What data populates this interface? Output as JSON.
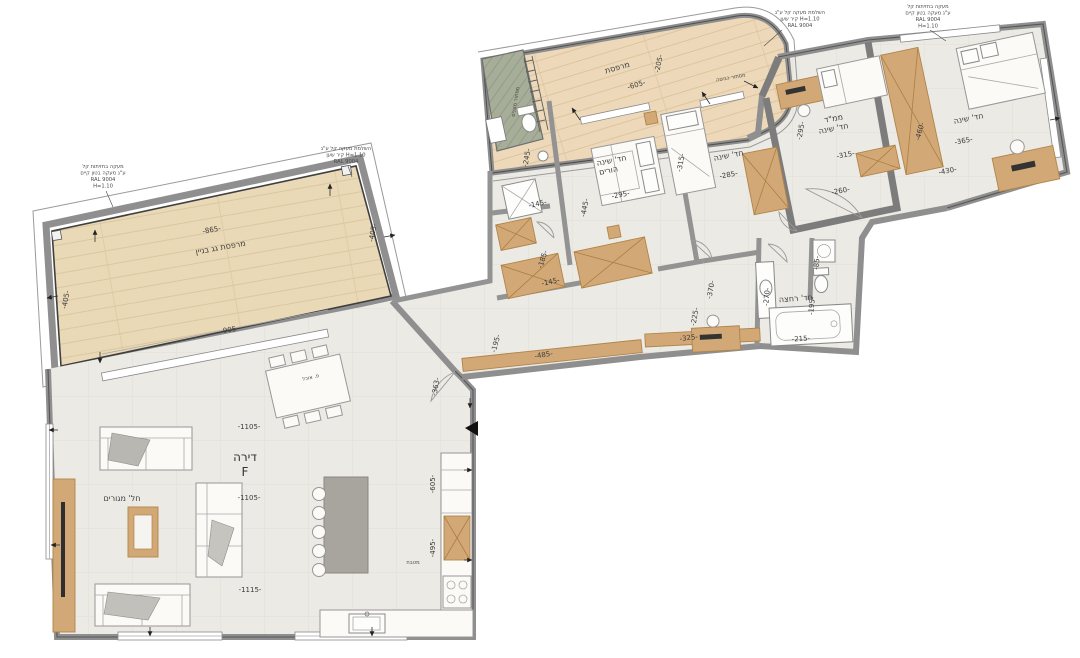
{
  "meta": {
    "drawing_type": "apartment floor plan",
    "unit_label": "דירה",
    "unit_letter": "F"
  },
  "colors": {
    "background": "#ffffff",
    "floor": "#eceae4",
    "floor_grid": "#e2dfd8",
    "roof_deck": "#e9d9b7",
    "balcony_deck": "#edd9ba",
    "wall": "#8f8f8f",
    "wood_furniture": "#d3a877",
    "kitchen_island": "#a8a49e",
    "ac_room_green": "#a6ad98",
    "marker_black": "#111111"
  },
  "rooms": {
    "roof_terrace": {
      "label": "מרפסת גג בניין",
      "dims": [
        "-865-",
        "-905-",
        "-405-",
        "-405-"
      ]
    },
    "balcony": {
      "label": "מרפסת",
      "dims": [
        "-605-",
        "-205-"
      ]
    },
    "living": {
      "label": "חל' מגורים",
      "dims": [
        "-1105-",
        "-1105-",
        "-1115-",
        "-363-"
      ]
    },
    "kitchen": {
      "label": "מטבח",
      "dims": [
        "-605-",
        "-495-"
      ]
    },
    "dining": {
      "label": "פ. אוכל"
    },
    "parents_bedroom": {
      "label": "חד' שינה הורים",
      "dims": [
        "-295-",
        "-445-"
      ]
    },
    "ensuite": {
      "dims": [
        "-245-",
        "-145-",
        "-185-",
        "-145-"
      ]
    },
    "bedroom2": {
      "label": "חד' שינה",
      "dims": [
        "-285-",
        "-315-"
      ]
    },
    "mamad": {
      "label": "ממ\"ד חד' שינה",
      "dims": [
        "-295-",
        "-315-",
        "-260-"
      ]
    },
    "bedroom3": {
      "label": "חד' שינה",
      "dims": [
        "-365-",
        "-430-",
        "-460-"
      ]
    },
    "bathroom": {
      "label": "חד' רחצה",
      "dims": [
        "-270-",
        "-195-",
        "-215-",
        "-85-"
      ]
    },
    "corridor": {
      "dims": [
        "-195-",
        "-485-",
        "-225-",
        "-370-",
        "-325-"
      ]
    },
    "ac_niche": {
      "label": "מסתור מזגנים"
    },
    "laundry_niche": {
      "label": "מסתור כביסה"
    }
  },
  "texts": [
    {
      "n": "roof-terrace-dim-top",
      "t": "-865-",
      "x": 212,
      "y": 232,
      "r": -10,
      "c": "dim"
    },
    {
      "n": "roof-terrace-label",
      "t": "מרפסת גג בניין",
      "x": 221,
      "y": 250,
      "r": -10,
      "c": "room"
    },
    {
      "n": "roof-terrace-dim-bottom",
      "t": "-905-",
      "x": 230,
      "y": 332,
      "r": -10,
      "c": "dim"
    },
    {
      "n": "roof-terrace-dim-left",
      "t": "-405-",
      "x": 68,
      "y": 300,
      "r": -80,
      "c": "dim"
    },
    {
      "n": "roof-terrace-dim-right",
      "t": "-405-",
      "x": 375,
      "y": 233,
      "r": -80,
      "c": "dim"
    },
    {
      "n": "note-railing-left-1",
      "t": "מעקה בחזיתות קל",
      "x": 103,
      "y": 168,
      "r": 0,
      "c": "tiny"
    },
    {
      "n": "note-railing-left-2",
      "t": "ע\"ג מעקה בטון קיים",
      "x": 103,
      "y": 174.5,
      "r": 0,
      "c": "tiny"
    },
    {
      "n": "note-railing-left-3",
      "t": "RAL 9004",
      "x": 103,
      "y": 181,
      "r": 0,
      "c": "tiny"
    },
    {
      "n": "note-railing-left-4",
      "t": "H=1.10",
      "x": 103,
      "y": 187.5,
      "r": 0,
      "c": "tiny"
    },
    {
      "n": "note-parapet-mid-1",
      "t": "השלמת מעקה קל ע\"ג",
      "x": 346,
      "y": 150,
      "r": 0,
      "c": "tiny"
    },
    {
      "n": "note-parapet-mid-2",
      "t": "קיר שען H=1.10",
      "x": 346,
      "y": 156.5,
      "r": 0,
      "c": "tiny"
    },
    {
      "n": "note-parapet-mid-3",
      "t": "RAL 9004",
      "x": 346,
      "y": 163,
      "r": 0,
      "c": "tiny"
    },
    {
      "n": "note-railing-curve-1",
      "t": "השלמת מעקה קל ע\"ג",
      "x": 800,
      "y": 14,
      "r": 0,
      "c": "tiny"
    },
    {
      "n": "note-railing-curve-2",
      "t": "קיר שען H=1.10",
      "x": 800,
      "y": 20.5,
      "r": 0,
      "c": "tiny"
    },
    {
      "n": "note-railing-curve-3",
      "t": "RAL 9004",
      "x": 800,
      "y": 27,
      "r": 0,
      "c": "tiny"
    },
    {
      "n": "note-railing-wing-1",
      "t": "מעקה בחזיתות קל",
      "x": 928,
      "y": 8,
      "r": 0,
      "c": "tiny"
    },
    {
      "n": "note-railing-wing-2",
      "t": "ע\"ג מעקה בטון קיים",
      "x": 928,
      "y": 14.5,
      "r": 0,
      "c": "tiny"
    },
    {
      "n": "note-railing-wing-3",
      "t": "RAL 9004",
      "x": 928,
      "y": 21,
      "r": 0,
      "c": "tiny"
    },
    {
      "n": "note-railing-wing-4",
      "t": "H=1.10",
      "x": 928,
      "y": 27.5,
      "r": 0,
      "c": "tiny"
    },
    {
      "n": "note-laundry",
      "t": "מסתור כביסה",
      "x": 731,
      "y": 79,
      "r": -10,
      "c": "tiny"
    },
    {
      "n": "balcony-label",
      "t": "מרפסת",
      "x": 618,
      "y": 70,
      "r": -16,
      "c": "room"
    },
    {
      "n": "balcony-dim-length",
      "t": "-605-",
      "x": 637,
      "y": 87,
      "r": -16,
      "c": "dim"
    },
    {
      "n": "balcony-dim-width",
      "t": "-205-",
      "x": 661,
      "y": 64,
      "r": -78,
      "c": "dim"
    },
    {
      "n": "ac-room-label",
      "t": "מסתור מזגנים",
      "x": 517,
      "y": 102,
      "r": -81,
      "c": "tiny"
    },
    {
      "n": "ensuite-dim-1",
      "t": "-245-",
      "x": 529,
      "y": 158,
      "r": -80,
      "c": "dim"
    },
    {
      "n": "ensuite-dim-2",
      "t": "-145-",
      "x": 538,
      "y": 206,
      "r": -12,
      "c": "dim"
    },
    {
      "n": "hall-dim-1",
      "t": "-185-",
      "x": 545,
      "y": 260,
      "r": -72,
      "c": "dim"
    },
    {
      "n": "hall-dim-2",
      "t": "-145-",
      "x": 551,
      "y": 284,
      "r": -12,
      "c": "dim"
    },
    {
      "n": "parents-room-label-1",
      "t": "חד' שינה",
      "x": 612,
      "y": 163,
      "r": -11,
      "c": "room"
    },
    {
      "n": "parents-room-label-2",
      "t": "הורים",
      "x": 609,
      "y": 173,
      "r": -11,
      "c": "room"
    },
    {
      "n": "parents-dim-width",
      "t": "-295-",
      "x": 621,
      "y": 197,
      "r": -11,
      "c": "dim"
    },
    {
      "n": "parents-dim-depth",
      "t": "-445-",
      "x": 587,
      "y": 208,
      "r": -80,
      "c": "dim"
    },
    {
      "n": "bedroom2-label",
      "t": "חד' שינה",
      "x": 729,
      "y": 158,
      "r": -11,
      "c": "room"
    },
    {
      "n": "bedroom2-dim-width",
      "t": "-285-",
      "x": 729,
      "y": 177,
      "r": -11,
      "c": "dim"
    },
    {
      "n": "bedroom2-dim-depth",
      "t": "-315-",
      "x": 683,
      "y": 163,
      "r": -80,
      "c": "dim"
    },
    {
      "n": "mamad-label-1",
      "t": "ממ\"ד",
      "x": 834,
      "y": 121,
      "r": -11,
      "c": "room"
    },
    {
      "n": "mamad-label-2",
      "t": "חד' שינה",
      "x": 834,
      "y": 131,
      "r": -11,
      "c": "room"
    },
    {
      "n": "mamad-dim-1",
      "t": "-315-",
      "x": 846,
      "y": 157,
      "r": -11,
      "c": "dim"
    },
    {
      "n": "mamad-dim-2",
      "t": "-295-",
      "x": 803,
      "y": 131,
      "r": -80,
      "c": "dim"
    },
    {
      "n": "mamad-dim-3",
      "t": "-260-",
      "x": 841,
      "y": 193,
      "r": -11,
      "c": "dim"
    },
    {
      "n": "bedroom3-label",
      "t": "חד' שינה",
      "x": 969,
      "y": 121,
      "r": -11,
      "c": "room"
    },
    {
      "n": "bedroom3-dim-1",
      "t": "-365-",
      "x": 964,
      "y": 143,
      "r": -11,
      "c": "dim"
    },
    {
      "n": "bedroom3-dim-2",
      "t": "-430-",
      "x": 948,
      "y": 173,
      "r": -11,
      "c": "dim"
    },
    {
      "n": "bedroom3-closet-dim",
      "t": "-460-",
      "x": 922,
      "y": 132,
      "r": -75,
      "c": "dim"
    },
    {
      "n": "bathroom-label",
      "t": "חד' רחצה",
      "x": 796,
      "y": 301,
      "r": -4,
      "c": "room"
    },
    {
      "n": "bathroom-dim-1",
      "t": "-270-",
      "x": 769,
      "y": 297,
      "r": -85,
      "c": "dim"
    },
    {
      "n": "bathroom-dim-2",
      "t": "-195-",
      "x": 814,
      "y": 306,
      "r": -85,
      "c": "dim"
    },
    {
      "n": "bathroom-dim-3",
      "t": "-215-",
      "x": 801,
      "y": 341,
      "r": -3,
      "c": "dim"
    },
    {
      "n": "bathroom-dim-4",
      "t": "-85-",
      "x": 819,
      "y": 263,
      "r": -85,
      "c": "dim"
    },
    {
      "n": "corridor-dim-1",
      "t": "-195-",
      "x": 498,
      "y": 344,
      "r": -75,
      "c": "dim"
    },
    {
      "n": "corridor-dim-2",
      "t": "-485-",
      "x": 544,
      "y": 357,
      "r": -9,
      "c": "dim"
    },
    {
      "n": "corridor-dim-3",
      "t": "-225-",
      "x": 697,
      "y": 317,
      "r": -80,
      "c": "dim"
    },
    {
      "n": "corridor-dim-4",
      "t": "-370-",
      "x": 713,
      "y": 290,
      "r": -80,
      "c": "dim"
    },
    {
      "n": "corridor-dim-5",
      "t": "-325-",
      "x": 689,
      "y": 340,
      "r": -7,
      "c": "dim"
    },
    {
      "n": "entry-dim",
      "t": "-363-",
      "x": 438,
      "y": 387,
      "r": -80,
      "c": "dim"
    },
    {
      "n": "living-dim-1",
      "t": "-1105-",
      "x": 249,
      "y": 429,
      "r": 0,
      "c": "dim"
    },
    {
      "n": "unit-label",
      "t": "דירה",
      "x": 245,
      "y": 461,
      "r": 0,
      "c": "unit"
    },
    {
      "n": "unit-letter",
      "t": "F",
      "x": 245,
      "y": 476,
      "r": 0,
      "c": "unit"
    },
    {
      "n": "living-dim-2",
      "t": "-1105-",
      "x": 249,
      "y": 500,
      "r": 0,
      "c": "dim"
    },
    {
      "n": "living-dim-3",
      "t": "-1115-",
      "x": 250,
      "y": 592,
      "r": 0,
      "c": "dim"
    },
    {
      "n": "living-label",
      "t": "חל' מגורים",
      "x": 122,
      "y": 501,
      "r": 0,
      "c": "room"
    },
    {
      "n": "dining-label",
      "t": "פ. אוכל",
      "x": 311,
      "y": 379,
      "r": -13,
      "c": "tiny"
    },
    {
      "n": "kitchen-dim-1",
      "t": "-605-",
      "x": 435,
      "y": 484,
      "r": -90,
      "c": "dim"
    },
    {
      "n": "kitchen-dim-2",
      "t": "-495-",
      "x": 435,
      "y": 548,
      "r": -90,
      "c": "dim"
    },
    {
      "n": "kitchen-label",
      "t": "מטבח",
      "x": 413,
      "y": 564,
      "r": 0,
      "c": "tiny"
    }
  ]
}
